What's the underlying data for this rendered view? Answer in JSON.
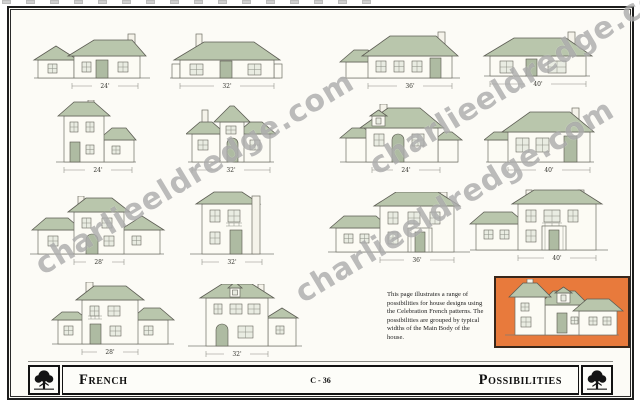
{
  "page": {
    "style_title": "French",
    "page_type_title": "Possibilities",
    "plate_number": "C - 36"
  },
  "watermark": {
    "text": "charlieeldredge.com"
  },
  "description": "This page illustrates a range of possibilities for house designs using the Celebration French patterns. The possibilities are grouped by typical widths of the Main Body of the house.",
  "footer": {
    "left_title": "French",
    "plate_number": "C - 36",
    "right_title": "Possibilities"
  },
  "houses": [
    {
      "id": "r1c1",
      "width_label": "24'"
    },
    {
      "id": "r1c2",
      "width_label": "32'"
    },
    {
      "id": "r1c3",
      "width_label": "36'"
    },
    {
      "id": "r1c4",
      "width_label": "40'"
    },
    {
      "id": "r2c1",
      "width_label": "24'"
    },
    {
      "id": "r2c2",
      "width_label": "32'"
    },
    {
      "id": "r2c3",
      "width_label": "24'"
    },
    {
      "id": "r2c4",
      "width_label": "40'"
    },
    {
      "id": "r3c1",
      "width_label": "28'"
    },
    {
      "id": "r3c2",
      "width_label": "32'"
    },
    {
      "id": "r3c3",
      "width_label": "36'"
    },
    {
      "id": "r3c4",
      "width_label": "40'"
    },
    {
      "id": "r4c1",
      "width_label": "28'"
    },
    {
      "id": "r4c2",
      "width_label": "32'"
    }
  ],
  "highlight": {
    "name": "featured-french-house"
  },
  "colors": {
    "roof_sage": "#b9c6ac",
    "highlight_orange": "#e87a3c",
    "frame_black": "#1d1d1d",
    "watermark_gray": "#787878",
    "paper": "#fcfbf6"
  }
}
